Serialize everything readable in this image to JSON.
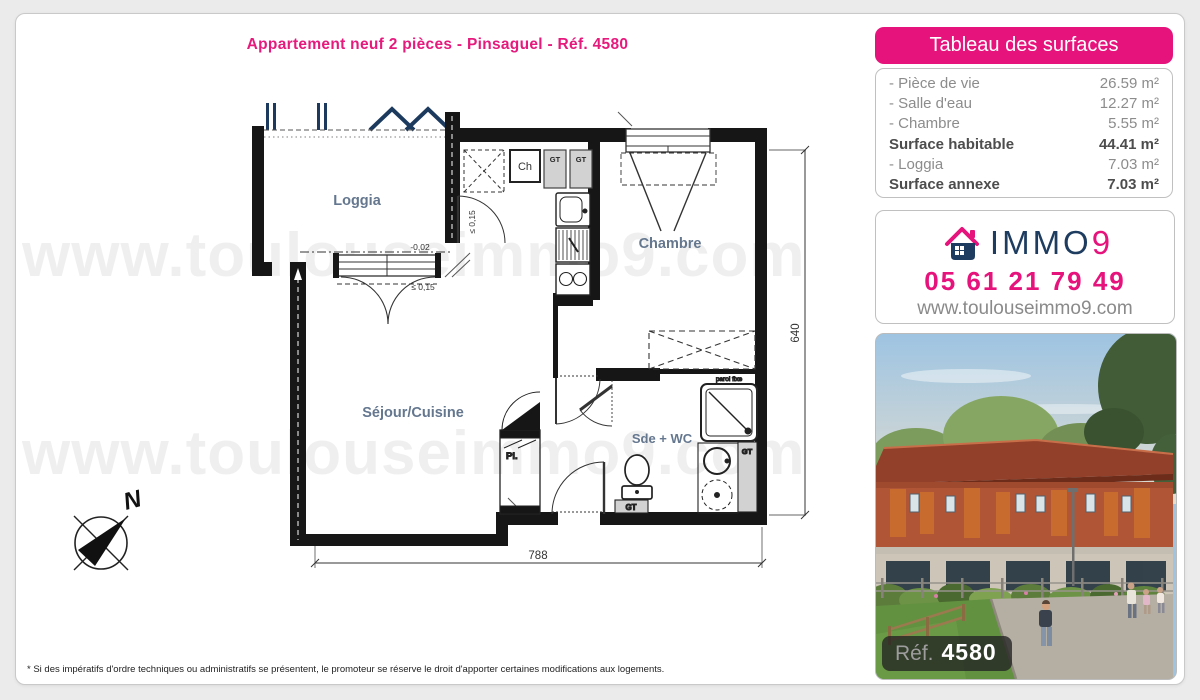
{
  "title": "Appartement neuf 2 pièces - Pinsaguel - Réf. 4580",
  "colors": {
    "pink": "#e6137c",
    "navy": "#1d3c5f",
    "room_label": "#64778f",
    "wall": "#161616"
  },
  "surfaces": {
    "header": "Tableau des surfaces",
    "rows": [
      {
        "label": "- Pièce de vie",
        "value": "26.59 m²"
      },
      {
        "label": "- Salle d'eau",
        "value": "12.27 m²"
      },
      {
        "label": "- Chambre",
        "value": "5.55 m²"
      },
      {
        "label": "Surface habitable",
        "value": "44.41 m²"
      },
      {
        "label": "- Loggia",
        "value": "7.03 m²"
      },
      {
        "label": "Surface annexe",
        "value": "7.03 m²"
      }
    ]
  },
  "agency": {
    "brand_immo": "IMMO",
    "brand_9": "9",
    "phone": "05 61 21 79 49",
    "website": "www.toulouseimmo9.com"
  },
  "photo": {
    "ref_label": "Réf.",
    "ref_number": "4580"
  },
  "plan": {
    "rooms": {
      "loggia": "Loggia",
      "chambre": "Chambre",
      "sejour": "Séjour/Cuisine",
      "sde": "Sde + WC"
    },
    "annotations": {
      "pl": "Pl.",
      "ch": "Ch",
      "gt": "GT",
      "paroi_fixe": "paroi fixe",
      "level": "-0,02",
      "seuil": "≤ 0,15",
      "dim_width": "788",
      "dim_height": "640",
      "north": "N"
    }
  },
  "watermark": "www.toulouseimmo9.com",
  "footnote": "* Si des impératifs d'ordre techniques ou administratifs se présentent, le promoteur se réserve le droit d'apporter certaines modifications aux logements."
}
